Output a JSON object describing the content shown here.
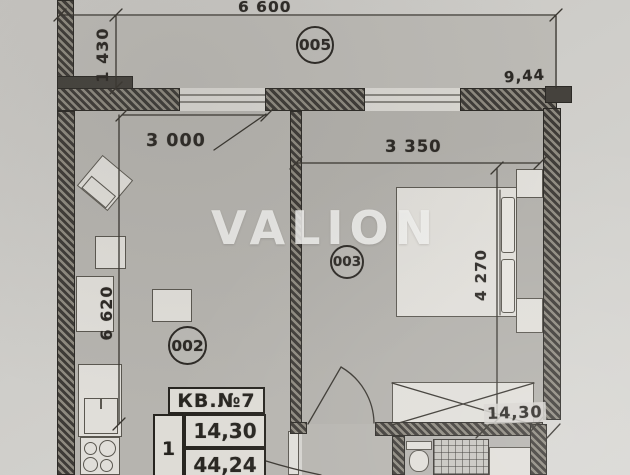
{
  "watermark": {
    "text": "VALION"
  },
  "plan": {
    "room_tags": {
      "balcony": "005",
      "living": "002",
      "bedroom": "003"
    },
    "dimensions": {
      "balcony_width": "6 600",
      "balcony_depth": "1 430",
      "balcony_area": "9,44",
      "living_width": "3 000",
      "bedroom_width": "3 350",
      "living_depth": "6 620",
      "bedroom_depth": "4 270",
      "bedroom_area": "14,30"
    },
    "apartment_table": {
      "title": "КВ.№7",
      "rooms_count": "1",
      "living_area": "14,30",
      "total_area": "44,24"
    },
    "colors": {
      "paper": "#cfcdc9",
      "floor": "#b5b3ae",
      "wall": "#3e3b37",
      "furniture": "#e0ded9",
      "ink": "#2c2925",
      "watermark": "#f4f4f1"
    }
  }
}
